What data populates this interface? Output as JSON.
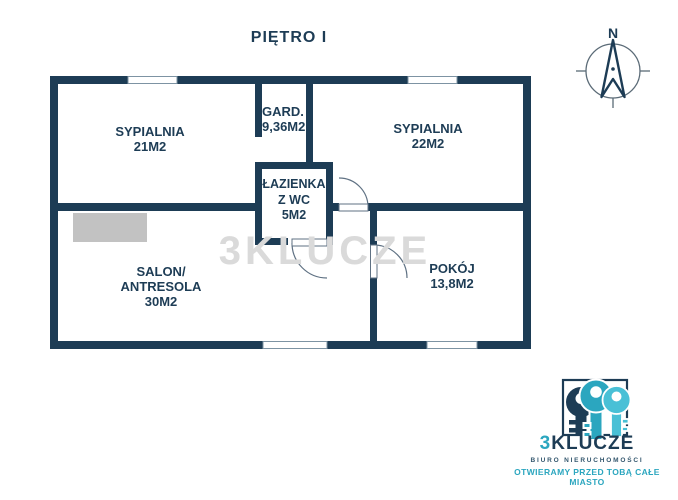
{
  "page": {
    "title": "PIĘTRO I"
  },
  "plan": {
    "rooms": {
      "bedroom1": {
        "name": "SYPIALNIA",
        "area": "21M2"
      },
      "wardrobe": {
        "name": "GARD.",
        "area": "9,36M2"
      },
      "bedroom2": {
        "name": "SYPIALNIA",
        "area": "22M2"
      },
      "bathroom": {
        "name": "ŁAZIENKA",
        "name2": "Z WC",
        "area": "5M2"
      },
      "living_room": {
        "name": "SALON/",
        "name2": "ANTRESOLA",
        "area": "30M2"
      },
      "room": {
        "name": "POKÓJ",
        "area": "13,8M2"
      }
    },
    "compass": {
      "north_label": "N"
    }
  },
  "watermark": {
    "text": "3KLUCZE"
  },
  "logo": {
    "brand_prefix": "3",
    "brand_suffix": "KLUCZE",
    "subtitle": "BIURO NIERUCHOMOŚCI",
    "tagline": "OTWIERAMY PRZED TOBĄ CAŁE MIASTO"
  },
  "colors": {
    "wall_navy": "#1d3c55",
    "key_teal": "#2ba6bf",
    "key_cyan": "#49c0d6",
    "key_navy": "#1d3c55",
    "watermark_gray": "#dadada",
    "stairs_gray": "#c2c2c2"
  }
}
